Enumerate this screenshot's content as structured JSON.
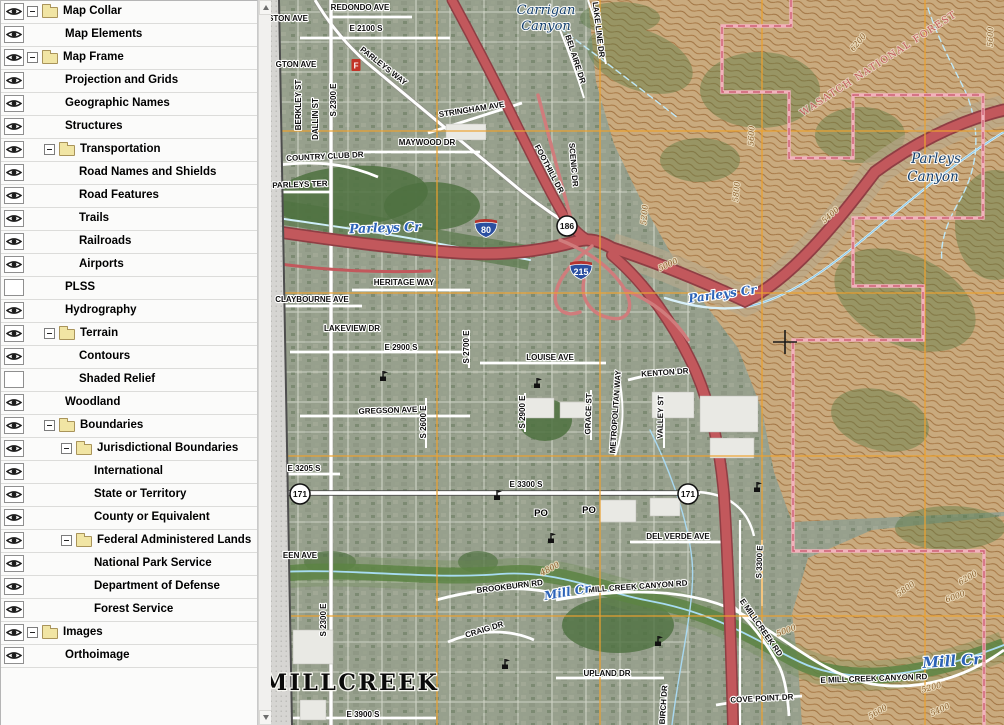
{
  "sidebar": {
    "layers": [
      {
        "label": "Map Collar",
        "level": 0,
        "group": true,
        "visible": true
      },
      {
        "label": "Map Elements",
        "level": 1,
        "group": false,
        "visible": true
      },
      {
        "label": "Map Frame",
        "level": 0,
        "group": true,
        "visible": true
      },
      {
        "label": "Projection and Grids",
        "level": 1,
        "group": false,
        "visible": true
      },
      {
        "label": "Geographic Names",
        "level": 1,
        "group": false,
        "visible": true
      },
      {
        "label": "Structures",
        "level": 1,
        "group": false,
        "visible": true
      },
      {
        "label": "Transportation",
        "level": 1,
        "group": true,
        "visible": true
      },
      {
        "label": "Road Names and Shields",
        "level": 2,
        "group": false,
        "visible": true
      },
      {
        "label": "Road Features",
        "level": 2,
        "group": false,
        "visible": true
      },
      {
        "label": "Trails",
        "level": 2,
        "group": false,
        "visible": true
      },
      {
        "label": "Railroads",
        "level": 2,
        "group": false,
        "visible": true
      },
      {
        "label": "Airports",
        "level": 2,
        "group": false,
        "visible": true
      },
      {
        "label": "PLSS",
        "level": 1,
        "group": false,
        "visible": false
      },
      {
        "label": "Hydrography",
        "level": 1,
        "group": false,
        "visible": true
      },
      {
        "label": "Terrain",
        "level": 1,
        "group": true,
        "visible": true
      },
      {
        "label": "Contours",
        "level": 2,
        "group": false,
        "visible": true
      },
      {
        "label": "Shaded Relief",
        "level": 2,
        "group": false,
        "visible": false
      },
      {
        "label": "Woodland",
        "level": 1,
        "group": false,
        "visible": true
      },
      {
        "label": "Boundaries",
        "level": 1,
        "group": true,
        "visible": true
      },
      {
        "label": "Jurisdictional Boundaries",
        "level": 2,
        "group": true,
        "visible": true
      },
      {
        "label": "International",
        "level": 3,
        "group": false,
        "visible": true
      },
      {
        "label": "State or Territory",
        "level": 3,
        "group": false,
        "visible": true
      },
      {
        "label": "County or Equivalent",
        "level": 3,
        "group": false,
        "visible": true
      },
      {
        "label": "Federal Administered Lands",
        "level": 2,
        "group": true,
        "visible": true
      },
      {
        "label": "National Park Service",
        "level": 3,
        "group": false,
        "visible": true
      },
      {
        "label": "Department of Defense",
        "level": 3,
        "group": false,
        "visible": true
      },
      {
        "label": "Forest Service",
        "level": 3,
        "group": false,
        "visible": true
      },
      {
        "label": "Images",
        "level": 0,
        "group": true,
        "visible": true
      },
      {
        "label": "Orthoimage",
        "level": 1,
        "group": false,
        "visible": true
      }
    ]
  },
  "map": {
    "colors": {
      "grid": "#eda22f",
      "boundary": "#f2b2bc",
      "boundary_dash": "#cd5f74",
      "highway": "#c2585c",
      "highway_casing": "#8f3e44",
      "ramp": "#d07c7c",
      "water": "#2c63b8",
      "forest": "#c25959",
      "contour": "#8a5e2a",
      "hills": "#c9aa7e",
      "urban": "#97a08d"
    },
    "grid": {
      "vertical_x": [
        437,
        600,
        762,
        925
      ],
      "horizontal_y": [
        131,
        293,
        456,
        616
      ]
    },
    "street_labels": [
      {
        "t": "REDONDO AVE",
        "x": 360,
        "y": 10,
        "r": 0
      },
      {
        "t": "E 2100 S",
        "x": 366,
        "y": 31,
        "r": 0
      },
      {
        "t": "PARLEYS WAY",
        "x": 382,
        "y": 68,
        "r": 38
      },
      {
        "t": "STON AVE",
        "x": 288,
        "y": 21,
        "r": 0
      },
      {
        "t": "GTON AVE",
        "x": 296,
        "y": 67,
        "r": 0
      },
      {
        "t": "BERKLEY ST",
        "x": 301,
        "y": 105,
        "r": -90
      },
      {
        "t": "DALLIN ST",
        "x": 318,
        "y": 119,
        "r": -90
      },
      {
        "t": "S 2300 E",
        "x": 336,
        "y": 100,
        "r": -90
      },
      {
        "t": "STRINGHAM AVE",
        "x": 472,
        "y": 112,
        "r": -9
      },
      {
        "t": "MAYWOOD DR",
        "x": 427,
        "y": 145,
        "r": 0
      },
      {
        "t": "COUNTRY CLUB DR",
        "x": 325,
        "y": 159,
        "r": -3
      },
      {
        "t": "PARLEYS TER",
        "x": 300,
        "y": 187,
        "r": -2
      },
      {
        "t": "FOOTHILL DR",
        "x": 547,
        "y": 170,
        "r": 62
      },
      {
        "t": "SCENIC DR",
        "x": 571,
        "y": 165,
        "r": 85
      },
      {
        "t": "BEL AIRE DR",
        "x": 573,
        "y": 60,
        "r": 72
      },
      {
        "t": "LAKE LINE DR",
        "x": 596,
        "y": 30,
        "r": 83
      },
      {
        "t": "HERITAGE WAY",
        "x": 404,
        "y": 285,
        "r": 0
      },
      {
        "t": "CLAYBOURNE AVE",
        "x": 312,
        "y": 302,
        "r": 0
      },
      {
        "t": "LAKEVIEW DR",
        "x": 352,
        "y": 331,
        "r": 0
      },
      {
        "t": "E 2900 S",
        "x": 401,
        "y": 350,
        "r": 0
      },
      {
        "t": "S 2700 E",
        "x": 469,
        "y": 347,
        "r": -90
      },
      {
        "t": "S 2600 E",
        "x": 426,
        "y": 422,
        "r": -90
      },
      {
        "t": "GREGSON AVE",
        "x": 388,
        "y": 413,
        "r": -2
      },
      {
        "t": "E 3205 S",
        "x": 304,
        "y": 471,
        "r": 0
      },
      {
        "t": "E 3300 S",
        "x": 526,
        "y": 487,
        "r": 0
      },
      {
        "t": "LOUISE AVE",
        "x": 550,
        "y": 360,
        "r": 0
      },
      {
        "t": "KENTON DR",
        "x": 665,
        "y": 375,
        "r": -4
      },
      {
        "t": "METROPOLITAN WAY",
        "x": 618,
        "y": 412,
        "r": -86
      },
      {
        "t": "S 2900 E",
        "x": 525,
        "y": 412,
        "r": -90
      },
      {
        "t": "GRACE ST",
        "x": 591,
        "y": 414,
        "r": -88
      },
      {
        "t": "VALLEY ST",
        "x": 663,
        "y": 417,
        "r": -89
      },
      {
        "t": "DEL VERDE AVE",
        "x": 678,
        "y": 539,
        "r": 0
      },
      {
        "t": "BROOKBURN RD",
        "x": 510,
        "y": 589,
        "r": -7
      },
      {
        "t": "MILL CREEK CANYON RD",
        "x": 638,
        "y": 589,
        "r": -4
      },
      {
        "t": "E MILL CREEK CANYON RD",
        "x": 874,
        "y": 681,
        "r": -2
      },
      {
        "t": "E MILLCREEK RD",
        "x": 759,
        "y": 629,
        "r": 55
      },
      {
        "t": "CRAIG DR",
        "x": 485,
        "y": 632,
        "r": -17
      },
      {
        "t": "UPLAND DR",
        "x": 607,
        "y": 676,
        "r": 0
      },
      {
        "t": "BIRCH DR",
        "x": 666,
        "y": 705,
        "r": -86
      },
      {
        "t": "COVE POINT DR",
        "x": 762,
        "y": 701,
        "r": -3
      },
      {
        "t": "E 3900 S",
        "x": 363,
        "y": 717,
        "r": 0
      },
      {
        "t": "EEN AVE",
        "x": 300,
        "y": 558,
        "r": 0
      },
      {
        "t": "S 2300 E",
        "x": 326,
        "y": 620,
        "r": -90
      },
      {
        "t": "S 3300 E",
        "x": 762,
        "y": 562,
        "r": -88
      }
    ],
    "water_labels": [
      {
        "t": "Parleys Cr",
        "x": 385,
        "y": 232,
        "r": -2,
        "s": 12.5
      },
      {
        "t": "Parleys Cr",
        "x": 723,
        "y": 298,
        "r": -8,
        "s": 12
      },
      {
        "t": "Mill Cr",
        "x": 568,
        "y": 596,
        "r": -10,
        "s": 12
      },
      {
        "t": "Mill Cr",
        "x": 952,
        "y": 666,
        "r": -4,
        "s": 15
      }
    ],
    "place_labels": [
      {
        "t": "Carrigan",
        "x": 546,
        "y": 14,
        "r": 0,
        "s": 13,
        "cls": "cy"
      },
      {
        "t": "Canyon",
        "x": 546,
        "y": 30,
        "r": 0,
        "s": 13,
        "cls": "cy"
      },
      {
        "t": "Parleys",
        "x": 936,
        "y": 163,
        "r": 0,
        "s": 13.5,
        "cls": "cy"
      },
      {
        "t": "Canyon",
        "x": 933,
        "y": 181,
        "r": 0,
        "s": 13.5,
        "cls": "cy"
      },
      {
        "t": "WASATCH NATIONAL FOREST",
        "x": 880,
        "y": 66,
        "r": -33,
        "s": 9.5,
        "cls": "forest"
      },
      {
        "t": "MILLCREEK",
        "x": 351,
        "y": 690,
        "r": 0,
        "s": 22,
        "cls": "place"
      }
    ],
    "contour_labels": [
      {
        "t": "6200",
        "x": 860,
        "y": 44,
        "r": -50
      },
      {
        "t": "5600",
        "x": 993,
        "y": 37,
        "r": -88
      },
      {
        "t": "5400",
        "x": 832,
        "y": 217,
        "r": -42
      },
      {
        "t": "5800",
        "x": 739,
        "y": 192,
        "r": -85
      },
      {
        "t": "5600",
        "x": 754,
        "y": 136,
        "r": -87
      },
      {
        "t": "5200",
        "x": 647,
        "y": 215,
        "r": -85
      },
      {
        "t": "5000",
        "x": 669,
        "y": 267,
        "r": -25
      },
      {
        "t": "4800",
        "x": 551,
        "y": 571,
        "r": -28
      },
      {
        "t": "5000",
        "x": 787,
        "y": 633,
        "r": -20
      },
      {
        "t": "5800",
        "x": 907,
        "y": 591,
        "r": -35
      },
      {
        "t": "6200",
        "x": 969,
        "y": 580,
        "r": -30
      },
      {
        "t": "6000",
        "x": 956,
        "y": 599,
        "r": -20
      },
      {
        "t": "5200",
        "x": 932,
        "y": 690,
        "r": -15
      },
      {
        "t": "5400",
        "x": 941,
        "y": 712,
        "r": -25
      },
      {
        "t": "5600",
        "x": 879,
        "y": 714,
        "r": -30
      }
    ],
    "shields": [
      {
        "type": "interstate",
        "text": "80",
        "x": 486,
        "y": 227
      },
      {
        "type": "interstate",
        "text": "215",
        "x": 581,
        "y": 269
      },
      {
        "type": "circle",
        "text": "186",
        "x": 567,
        "y": 226
      },
      {
        "type": "circle",
        "text": "171",
        "x": 300,
        "y": 494
      },
      {
        "type": "circle",
        "text": "171",
        "x": 688,
        "y": 494
      }
    ],
    "poi": {
      "churches": [
        [
          383,
          381
        ],
        [
          537,
          388
        ],
        [
          497,
          500
        ],
        [
          551,
          543
        ],
        [
          505,
          669
        ],
        [
          658,
          646
        ],
        [
          757,
          492
        ]
      ],
      "post_offices": [
        {
          "t": "PO",
          "x": 541,
          "y": 516
        },
        {
          "t": "PO",
          "x": 589,
          "y": 513
        }
      ],
      "fire_station": {
        "t": "F",
        "x": 356,
        "y": 66
      }
    },
    "cursor": {
      "x": 785,
      "y": 342
    }
  }
}
